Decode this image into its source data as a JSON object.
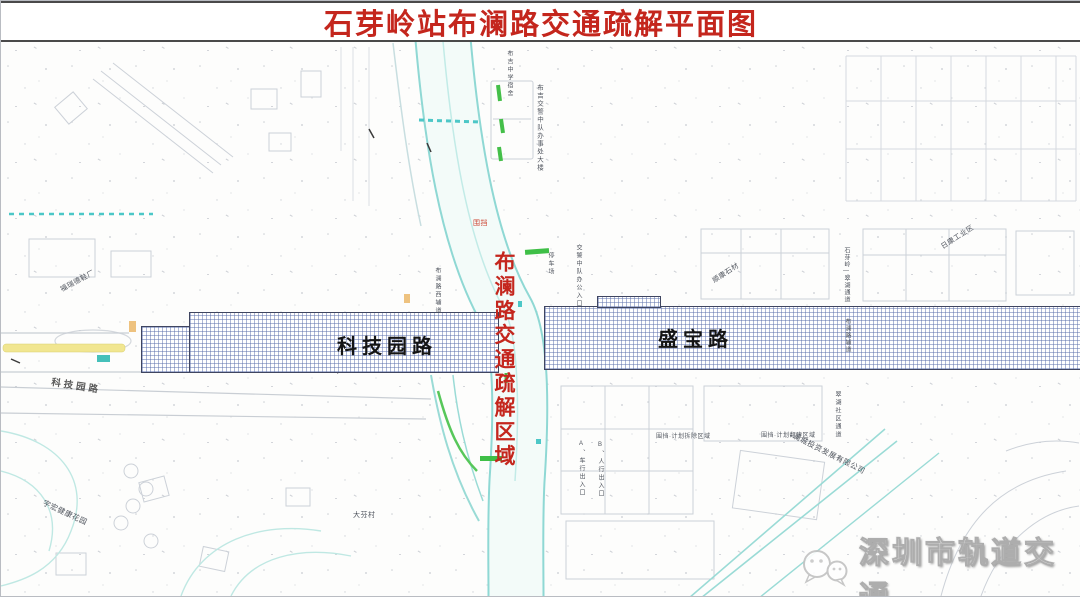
{
  "title": "石芽岭站布澜路交通疏解平面图",
  "band": {
    "left_road": "科技园路",
    "right_road": "盛宝路"
  },
  "diversion_zone": "布澜路交通疏解区域",
  "side_road": "科技园路",
  "watermark": "深圳市轨道交通",
  "micro_labels": [
    "布吉交警中队办事处大楼",
    "布吉中学宿舍",
    "交警中队办公入口",
    "停车场",
    "顺康石材",
    "石芽岭—翠湖通道",
    "布澜路辅道",
    "日康工业区",
    "福瑞德鞋厂",
    "围挡·计划拆除区域",
    "围挡·计划翻建区域",
    "A、车行出入口",
    "B、人行出入口",
    "澜城投资发展有限公司",
    "宇宏健康花园",
    "大芬村",
    "围挡",
    "布澜路西辅道",
    "翠湖社区通道"
  ],
  "colors": {
    "title_red": "#c4261d",
    "hatch_line": "#5c70ac",
    "road_teal": "#94d9d4",
    "marking_green": "#44bf49",
    "median_yellow": "#f1e690"
  }
}
